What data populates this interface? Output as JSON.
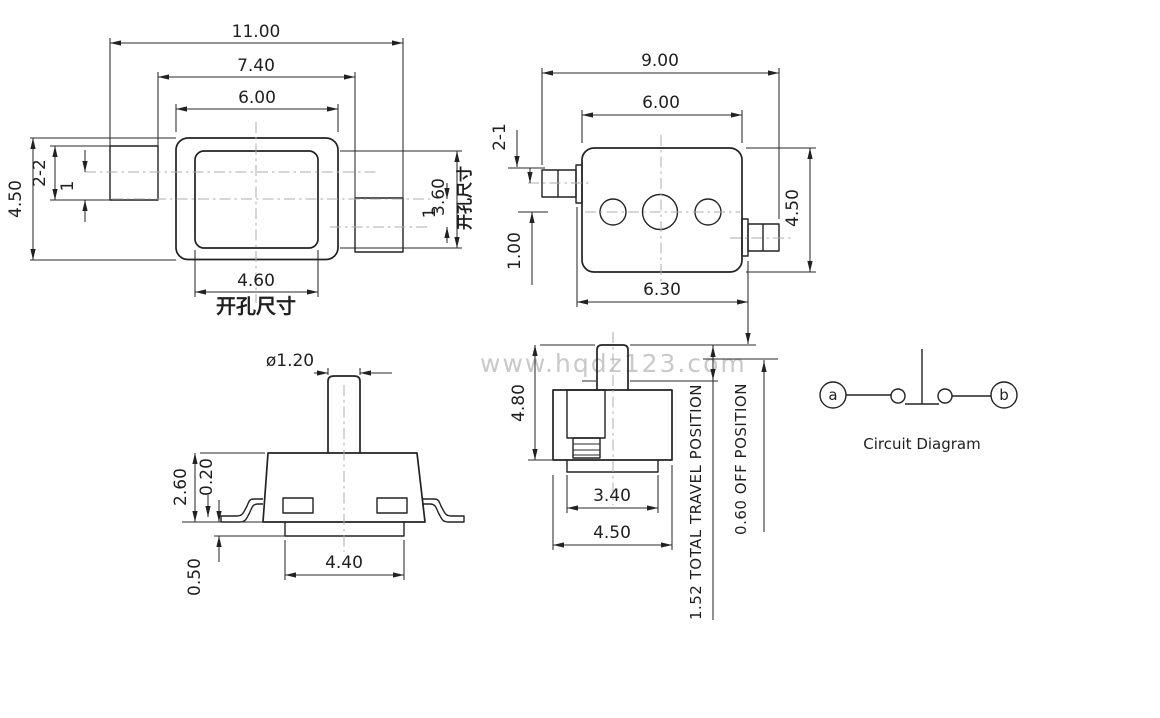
{
  "watermark": "www.hqdz123.com",
  "colors": {
    "line": "#222222",
    "centerline": "#adadad",
    "watermark": "#c9c9c9",
    "background": "#ffffff"
  },
  "views": {
    "top_left": {
      "dims": {
        "overall_width": "11.00",
        "inner_width": "7.40",
        "body_width": "6.00",
        "hole_width": "4.60",
        "hole_height": "3.60",
        "body_height": "4.50",
        "terminal_size": "2-2",
        "offset_left": "1",
        "offset_right": "1"
      },
      "labels": {
        "hole_bottom": "开孔尺寸",
        "hole_right": "开孔尺寸"
      }
    },
    "top_right": {
      "dims": {
        "overall_width": "9.00",
        "body_width": "6.00",
        "base_width": "6.30",
        "body_height": "4.50",
        "terminal_size": "2-1",
        "offset": "1.00"
      }
    },
    "bottom_left": {
      "dims": {
        "stem_diameter": "ø1.20",
        "body_height": "2.60",
        "lead_thickness": "0.20",
        "boss_height": "0.50",
        "lead_span": "4.40"
      }
    },
    "bottom_middle": {
      "dims": {
        "total_height": "4.80",
        "boss_width": "3.40",
        "base_width": "4.50"
      },
      "notes": {
        "travel": "1.52 TOTAL TRAVEL POSITION",
        "off": "0.60 OFF POSITION"
      }
    },
    "circuit": {
      "terminal_a": "a",
      "terminal_b": "b",
      "caption": "Circuit Diagram"
    }
  }
}
